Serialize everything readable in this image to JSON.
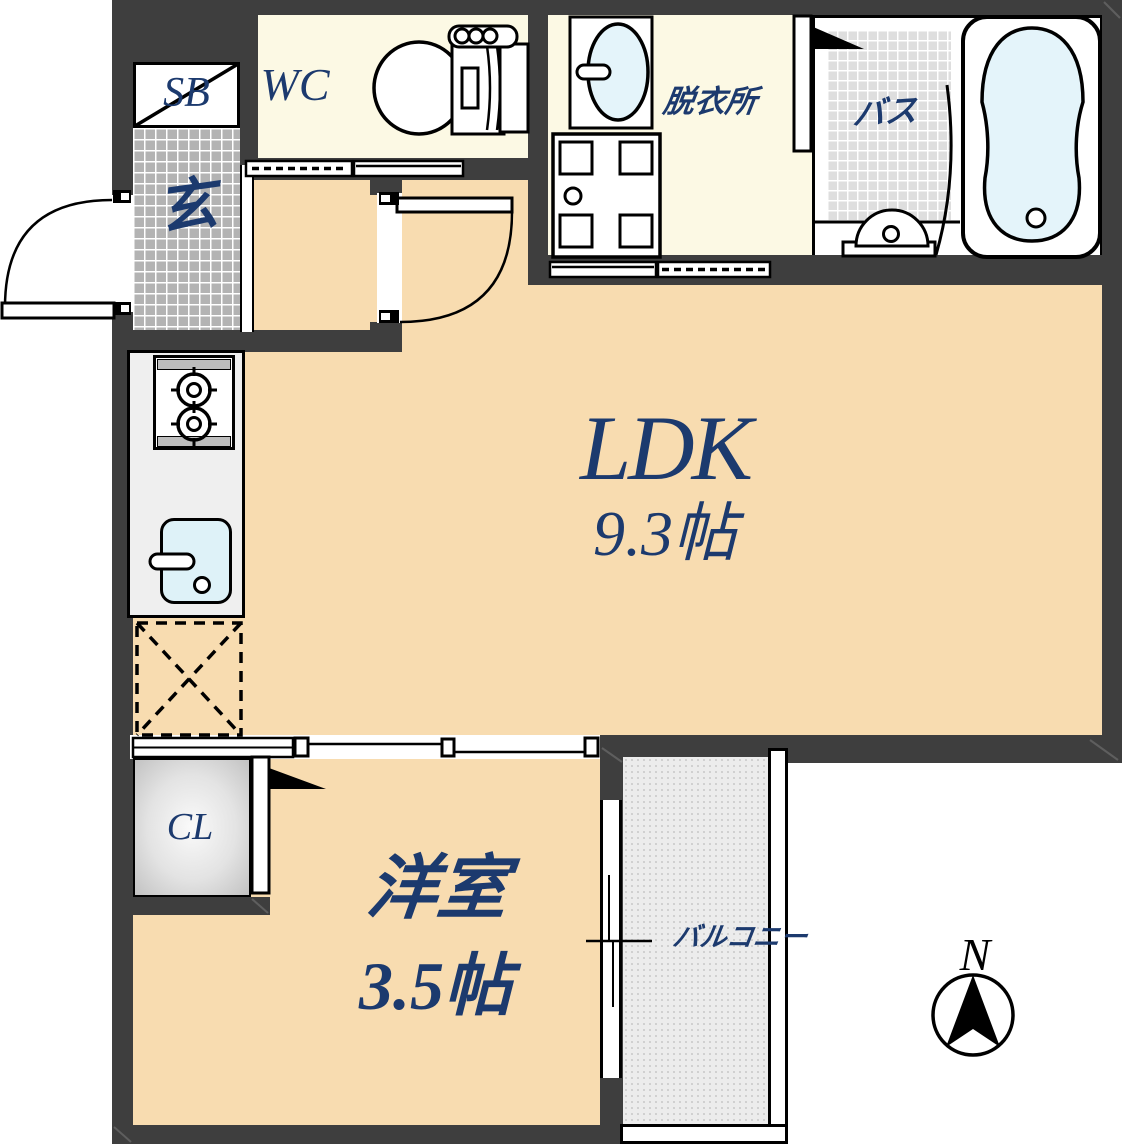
{
  "floor_plan": {
    "rooms": {
      "ldk": {
        "name": "LDK",
        "size": "9.3帖"
      },
      "western_room": {
        "name": "洋室",
        "size": "3.5帖"
      },
      "balcony": {
        "name": "バルコニー"
      },
      "bath": {
        "name": "バス"
      },
      "dressing_room": {
        "name": "脱衣所"
      },
      "wc": {
        "name": "WC"
      },
      "entrance": {
        "name": "玄"
      },
      "shoe_box": {
        "name": "SB"
      },
      "closet": {
        "name": "CL"
      }
    },
    "compass": {
      "north": "N"
    },
    "colors": {
      "wall": "#3e3e3e",
      "floor": "#f8dcb0",
      "service_floor": "#fcf9e4",
      "label_text": "#1c3a6e",
      "entrance_tile": "#b3b3b3",
      "bath_tile": "#dedede",
      "water": "#e4f4fa",
      "balcony_floor": "#ececec"
    }
  }
}
